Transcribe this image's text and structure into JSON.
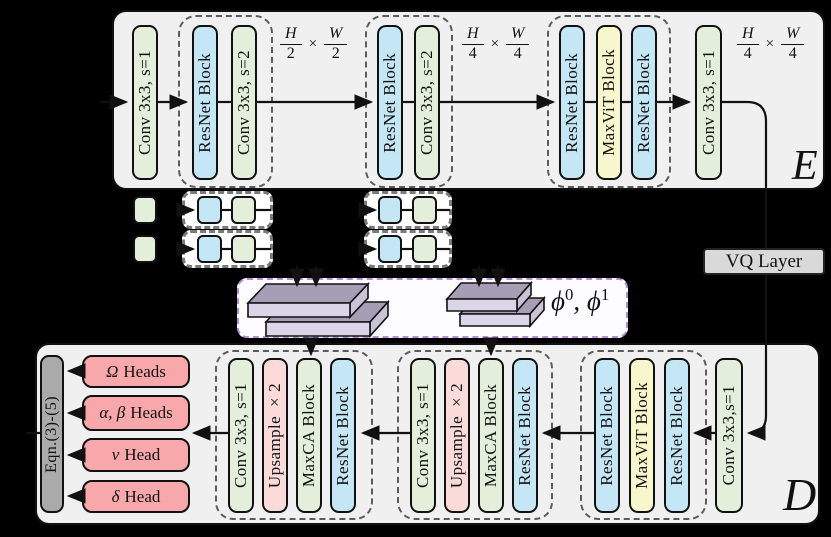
{
  "figure": {
    "encoder": {
      "panel_label": "E",
      "conv_in": "Conv 3x3, s=1",
      "group1": [
        "ResNet Block",
        "Conv 3x3, s=2"
      ],
      "dim1": {
        "num_l": "H",
        "den_l": "2",
        "times": "×",
        "num_r": "W",
        "den_r": "2"
      },
      "group2": [
        "ResNet Block",
        "Conv 3x3, s=2"
      ],
      "dim2": {
        "num_l": "H",
        "den_l": "4",
        "times": "×",
        "num_r": "W",
        "den_r": "4"
      },
      "group3": [
        "ResNet Block",
        "MaxViT Block",
        "ResNet Block"
      ],
      "conv_out": "Conv 3x3, s=1",
      "dim3": {
        "num_l": "H",
        "den_l": "4",
        "times": "×",
        "num_r": "W",
        "den_r": "4"
      }
    },
    "vq": {
      "label": "VQ Layer"
    },
    "latent": {
      "phi0": "ϕ",
      "phi0_sup": "0",
      "sep": ", ",
      "phi1": "ϕ",
      "phi1_sup": "1"
    },
    "decoder": {
      "panel_label": "D",
      "eqn_label": "Eqn.(3)-(5)",
      "heads": [
        {
          "sym": "Ω",
          "text": "Heads"
        },
        {
          "sym": "α, β",
          "text": "Heads"
        },
        {
          "sym": "ν",
          "text": "Head"
        },
        {
          "sym": "δ",
          "text": "Head"
        }
      ],
      "group1": [
        "Conv 3x3, s=1",
        "Upsample ×2",
        "MaxCA Block",
        "ResNet Block"
      ],
      "group2": [
        "Conv 3x3, s=1",
        "Upsample ×2",
        "MaxCA Block",
        "ResNet Block"
      ],
      "group3": [
        "ResNet Block",
        "MaxViT Block",
        "ResNet Block"
      ],
      "conv_in": "Conv 3x3,s=1"
    },
    "colors": {
      "conv_green": "#e3efdb",
      "resnet_blue": "#c5e6f5",
      "maxvit_yellow": "#f8f6cc",
      "upsample_pink": "#fadbd9",
      "head_red": "#f8a8aa",
      "eqn_gray": "#aaaaaa",
      "panel_bg": "#f0f0f0",
      "purple_border": "#b48fd9"
    }
  }
}
